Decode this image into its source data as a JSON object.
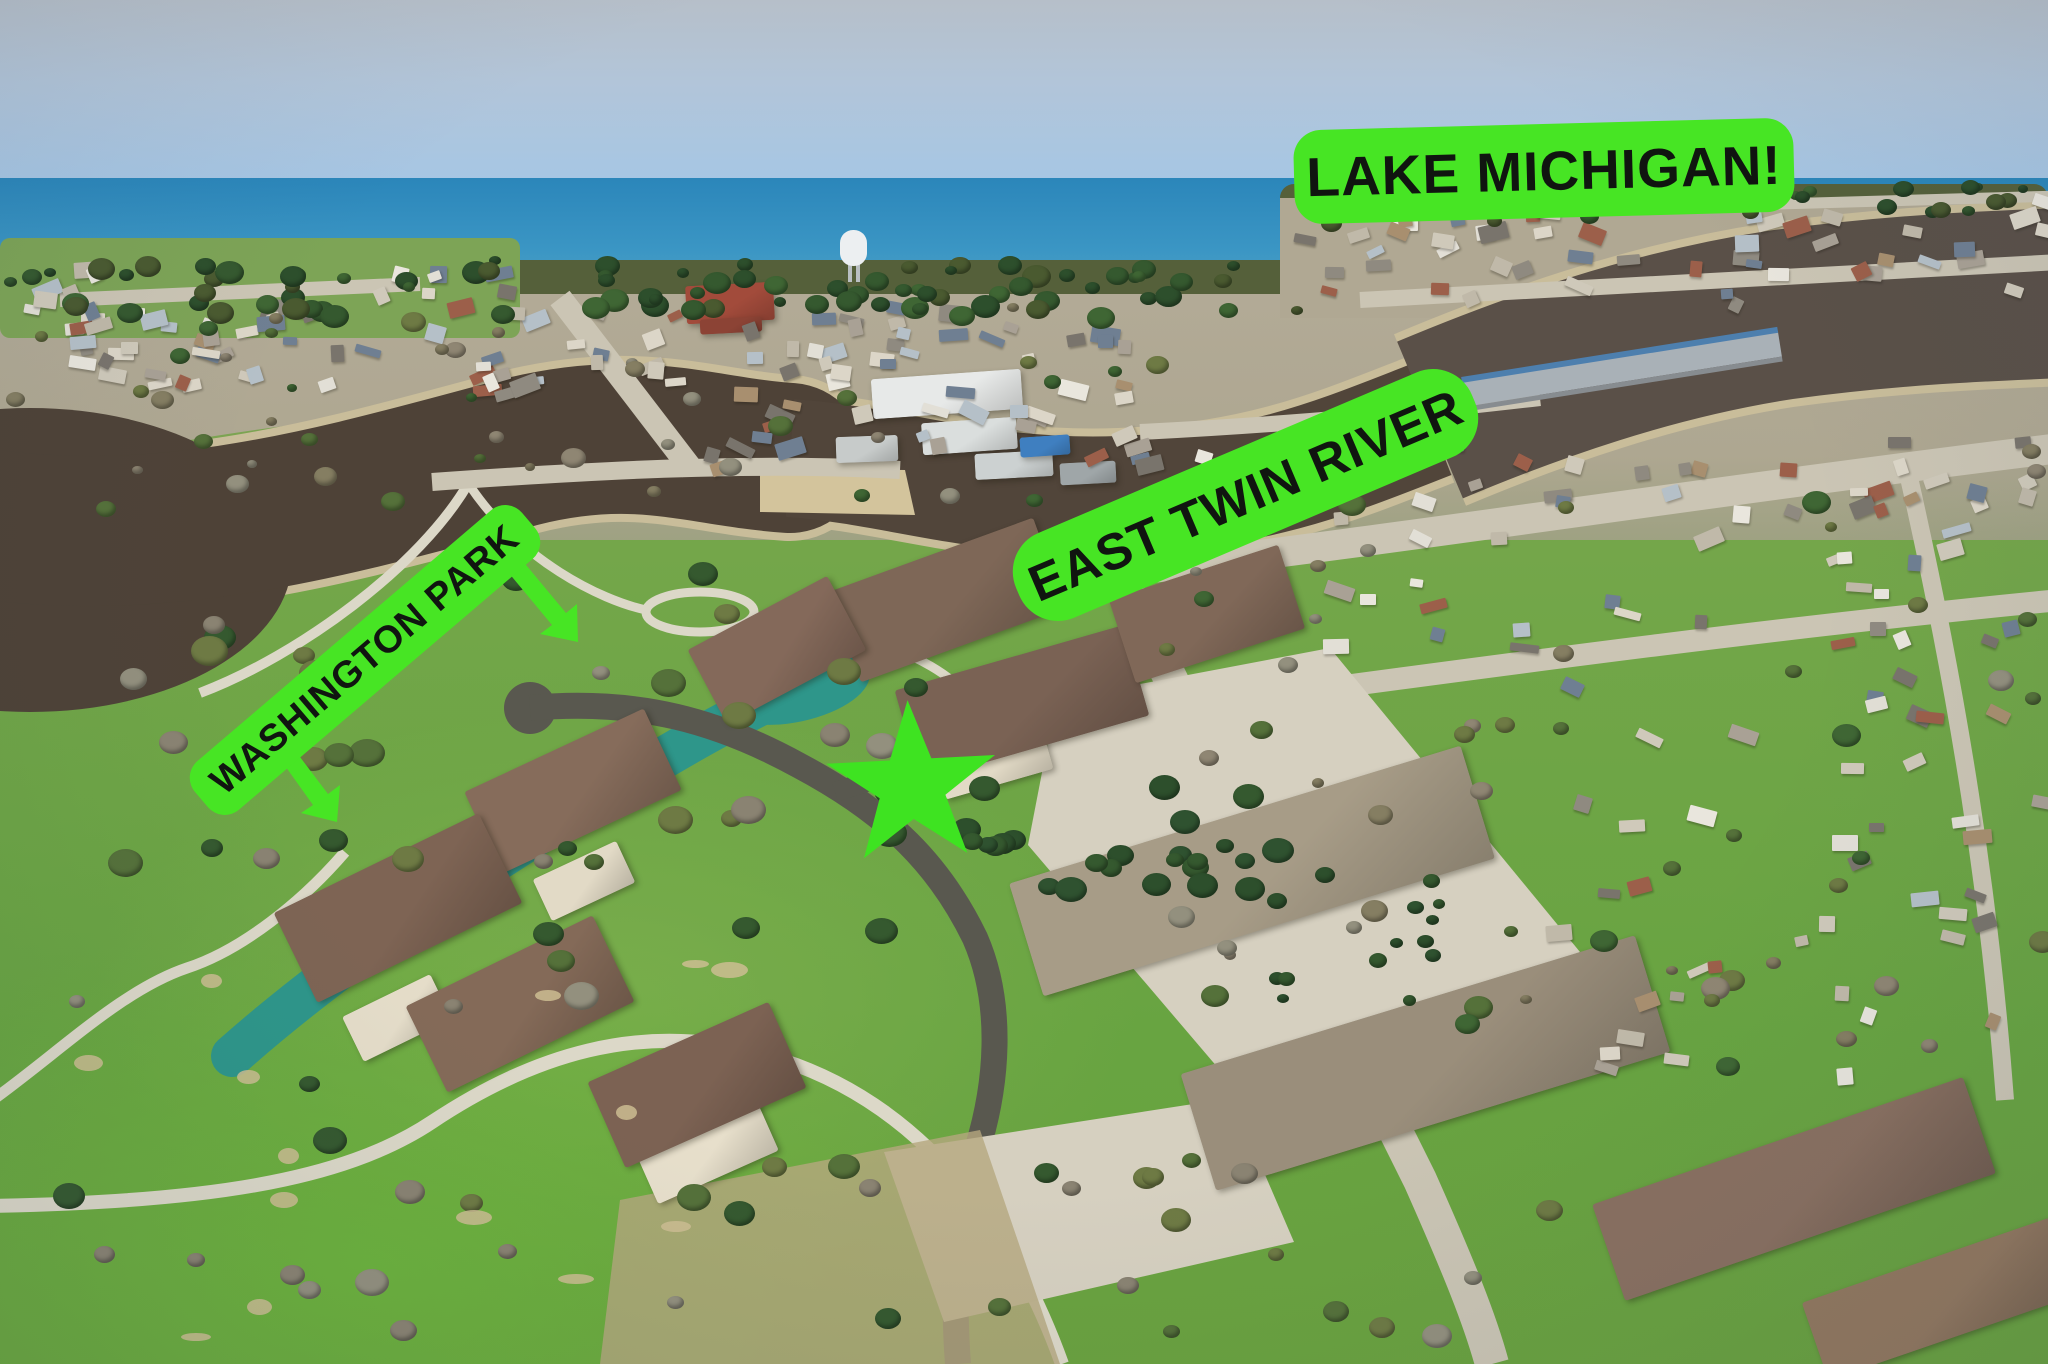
{
  "annotations": {
    "badge_color": "#47e524",
    "text_color": "#101510",
    "lake_michigan": {
      "text": "LAKE MICHIGAN!"
    },
    "east_twin_river": {
      "text": "EAST TWIN RIVER"
    },
    "washington_park": {
      "text": "WASHINGTON PARK"
    },
    "star_marker": {
      "shape": "5-point-star",
      "color": "#3ee321"
    },
    "arrow_count": 2
  },
  "scene_palette": {
    "sky": "#b2c5d9",
    "lake_water": "#2e8bbd",
    "river_water": "#4e4237",
    "canal_pond_water": "#2e968a",
    "grass": "#6fa647",
    "bright_lawn": "#6cb23c",
    "shore_trees": "#55603a",
    "concrete_street": "#cbc5b4",
    "asphalt_road": "#59584f",
    "condo_roof": "#7e6757",
    "rowhouse_roof": "#a79c87",
    "parking_lot": "#d6d0c0"
  }
}
